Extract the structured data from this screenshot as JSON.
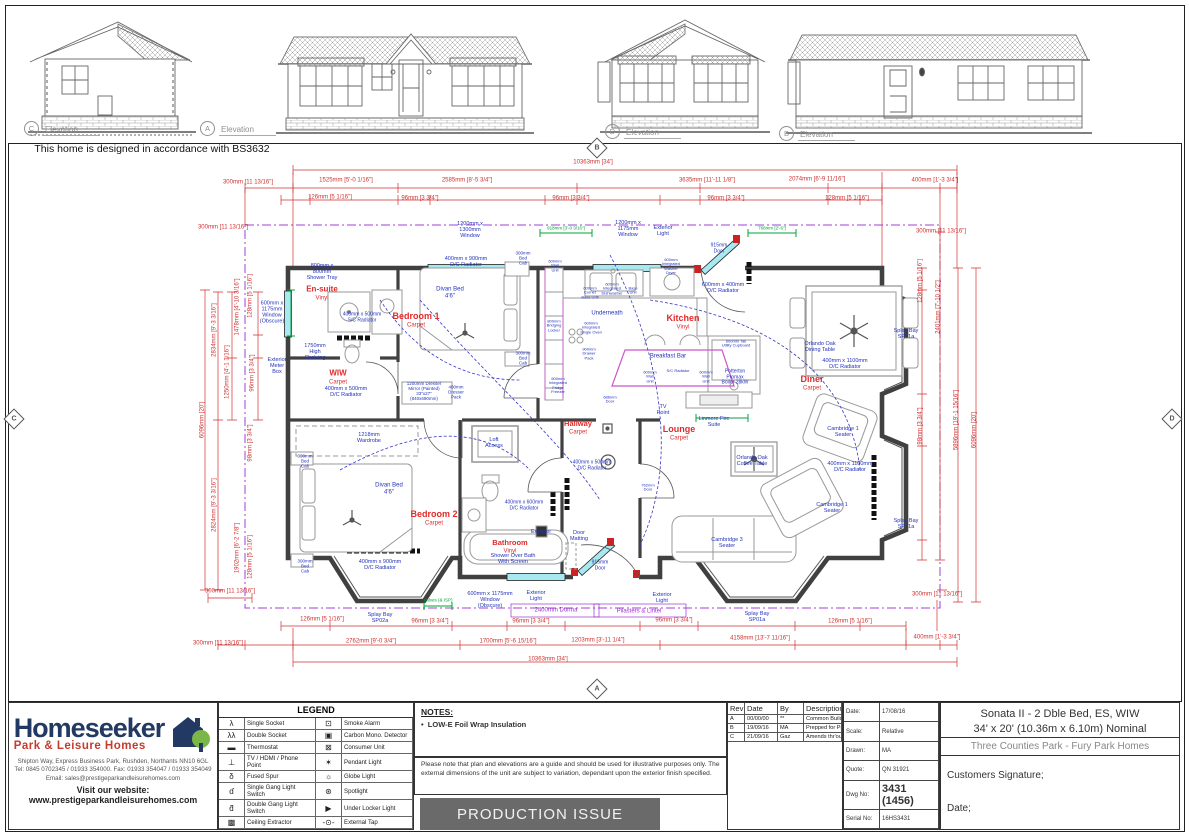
{
  "bs_note": "This home is designed in accordance with BS3632",
  "elevation_markers": [
    {
      "id": "C",
      "label": "Elevation",
      "x": 24,
      "y": 121
    },
    {
      "id": "A",
      "label": "Elevation",
      "x": 200,
      "y": 121
    },
    {
      "id": "D",
      "label": "Elevation",
      "x": 605,
      "y": 124
    },
    {
      "id": "B",
      "label": "Elevation",
      "x": 779,
      "y": 126
    }
  ],
  "view_markers": [
    {
      "id": "B",
      "x": 597,
      "y": 148
    },
    {
      "id": "C",
      "x": 14,
      "y": 419
    },
    {
      "id": "D",
      "x": 1172,
      "y": 419
    },
    {
      "id": "A",
      "x": 597,
      "y": 689
    }
  ],
  "plan_texts": [
    {
      "x": 322,
      "y": 290,
      "t": "En-suite",
      "c": "red",
      "fs": 8,
      "b": 1
    },
    {
      "x": 322,
      "y": 299,
      "t": "Vinyl",
      "c": "red",
      "fs": 6
    },
    {
      "x": 416,
      "y": 316,
      "t": "Bedroom 1",
      "c": "red",
      "fs": 9,
      "b": 1
    },
    {
      "x": 416,
      "y": 326,
      "t": "Carpet",
      "c": "red",
      "fs": 6
    },
    {
      "x": 338,
      "y": 374,
      "t": "WIW",
      "c": "red",
      "fs": 8,
      "b": 1
    },
    {
      "x": 338,
      "y": 383,
      "t": "Carpet",
      "c": "red",
      "fs": 6
    },
    {
      "x": 683,
      "y": 318,
      "t": "Kitchen",
      "c": "red",
      "fs": 9,
      "b": 1
    },
    {
      "x": 683,
      "y": 328,
      "t": "Vinyl",
      "c": "red",
      "fs": 6
    },
    {
      "x": 812,
      "y": 379,
      "t": "Diner",
      "c": "red",
      "fs": 9,
      "b": 1
    },
    {
      "x": 812,
      "y": 389,
      "t": "Carpet",
      "c": "red",
      "fs": 6
    },
    {
      "x": 679,
      "y": 429,
      "t": "Lounge",
      "c": "red",
      "fs": 9,
      "b": 1
    },
    {
      "x": 679,
      "y": 439,
      "t": "Carpet",
      "c": "red",
      "fs": 6
    },
    {
      "x": 578,
      "y": 424,
      "t": "Hallway",
      "c": "red",
      "fs": 7.5,
      "b": 1
    },
    {
      "x": 578,
      "y": 433,
      "t": "Carpet",
      "c": "red",
      "fs": 6
    },
    {
      "x": 434,
      "y": 514,
      "t": "Bedroom 2",
      "c": "red",
      "fs": 9,
      "b": 1
    },
    {
      "x": 434,
      "y": 524,
      "t": "Carpet",
      "c": "red",
      "fs": 6
    },
    {
      "x": 510,
      "y": 543,
      "t": "Bathroom",
      "c": "red",
      "fs": 7.5,
      "b": 1
    },
    {
      "x": 510,
      "y": 552,
      "t": "Vinyl",
      "c": "red",
      "fs": 6
    },
    {
      "x": 322,
      "y": 272,
      "t": "800mm x\n800mm\nShower Tray",
      "c": "blue",
      "fs": 5.5
    },
    {
      "x": 272,
      "y": 313,
      "t": "600mm x\n1175mm\nWindow\n(Obscure)",
      "c": "blue",
      "fs": 5.5
    },
    {
      "x": 362,
      "y": 318,
      "t": "400mm x 500mm\nS/C Radiator",
      "c": "blue",
      "fs": 5
    },
    {
      "x": 315,
      "y": 352,
      "t": "1750mm\nHigh\nShelving",
      "c": "blue",
      "fs": 5.5
    },
    {
      "x": 277,
      "y": 366,
      "t": "Exterior\nMeter\nBox",
      "c": "blue",
      "fs": 5.5
    },
    {
      "x": 346,
      "y": 392,
      "t": "400mm x 500mm\nD/C Radiator",
      "c": "blue",
      "fs": 5.5
    },
    {
      "x": 424,
      "y": 391,
      "t": "1200mm Dresser\nMirror (Painted)\n33\"x27\"\n(840x690mm)",
      "c": "blue",
      "fs": 4.5
    },
    {
      "x": 456,
      "y": 392,
      "t": "400mm\nDresser\nPack",
      "c": "blue",
      "fs": 4.5
    },
    {
      "x": 470,
      "y": 230,
      "t": "1200mm x\n1300mm\nWindow",
      "c": "blue",
      "fs": 5.5
    },
    {
      "x": 466,
      "y": 262,
      "t": "400mm x 900mm\nD/C Radiator",
      "c": "blue",
      "fs": 5.5
    },
    {
      "x": 450,
      "y": 293,
      "t": "Divan Bed\n4'6\"",
      "c": "blue",
      "fs": 6
    },
    {
      "x": 523,
      "y": 258,
      "t": "300mm\nBed\nCab",
      "c": "blue",
      "fs": 4.5
    },
    {
      "x": 523,
      "y": 358,
      "t": "300mm\nBed\nCab",
      "c": "blue",
      "fs": 4.5
    },
    {
      "x": 369,
      "y": 438,
      "t": "1218mm\nWardrobe",
      "c": "blue",
      "fs": 5.5
    },
    {
      "x": 389,
      "y": 489,
      "t": "Divan Bed\n4'6\"",
      "c": "blue",
      "fs": 6
    },
    {
      "x": 305,
      "y": 461,
      "t": "300mm\nBed\nCab",
      "c": "blue",
      "fs": 4.5
    },
    {
      "x": 305,
      "y": 566,
      "t": "300mm\nBed\nCab",
      "c": "blue",
      "fs": 4.5
    },
    {
      "x": 380,
      "y": 565,
      "t": "400mm x 900mm\nD/C Radiator",
      "c": "blue",
      "fs": 5.5
    },
    {
      "x": 494,
      "y": 443,
      "t": "Loft\nAccess",
      "c": "blue",
      "fs": 5.5
    },
    {
      "x": 524,
      "y": 506,
      "t": "400mm x 600mm\nD/C Radiator",
      "c": "blue",
      "fs": 5
    },
    {
      "x": 541,
      "y": 533,
      "t": "Extractor",
      "c": "blue",
      "fs": 5
    },
    {
      "x": 513,
      "y": 559,
      "t": "Shower Over Bath\nWith Screen",
      "c": "blue",
      "fs": 5.5
    },
    {
      "x": 490,
      "y": 600,
      "t": "600mm x 1175mm\nWindow\n(Obscure)",
      "c": "blue",
      "fs": 5.5
    },
    {
      "x": 536,
      "y": 596,
      "t": "Exterior\nLight",
      "c": "blue",
      "fs": 5.5
    },
    {
      "x": 662,
      "y": 598,
      "t": "Exterior\nLight",
      "c": "blue",
      "fs": 5.5
    },
    {
      "x": 600,
      "y": 566,
      "t": "915mm\nDoor",
      "c": "blue",
      "fs": 5
    },
    {
      "x": 579,
      "y": 536,
      "t": "Door\nMatting",
      "c": "blue",
      "fs": 5.5
    },
    {
      "x": 592,
      "y": 466,
      "t": "400mm x 500mm\nD/C Radiator",
      "c": "blue",
      "fs": 5
    },
    {
      "x": 663,
      "y": 410,
      "t": "TV\nPoint",
      "c": "blue",
      "fs": 5.5
    },
    {
      "x": 714,
      "y": 422,
      "t": "Linmere Fire\nSuite",
      "c": "blue",
      "fs": 5.5
    },
    {
      "x": 752,
      "y": 461,
      "t": "Orlando Oak\nCoffee Table",
      "c": "blue",
      "fs": 5.5
    },
    {
      "x": 843,
      "y": 432,
      "t": "Cambridge 1\nSeater",
      "c": "blue",
      "fs": 5.5
    },
    {
      "x": 832,
      "y": 508,
      "t": "Cambridge 1\nSeater",
      "c": "blue",
      "fs": 5.5
    },
    {
      "x": 727,
      "y": 543,
      "t": "Cambridge 3\nSeater",
      "c": "blue",
      "fs": 5.5
    },
    {
      "x": 850,
      "y": 467,
      "t": "400mm x 1100mm\nD/C Radiator",
      "c": "blue",
      "fs": 5.5
    },
    {
      "x": 845,
      "y": 364,
      "t": "400mm x 1100mm\nD/C Radiator",
      "c": "blue",
      "fs": 5.5
    },
    {
      "x": 820,
      "y": 347,
      "t": "Orlando Oak\nDining Table",
      "c": "blue",
      "fs": 5.5
    },
    {
      "x": 906,
      "y": 334,
      "t": "Splay Bay\nSP01a",
      "c": "blue",
      "fs": 5.5
    },
    {
      "x": 906,
      "y": 524,
      "t": "Splay Bay\nSP01a",
      "c": "blue",
      "fs": 5.5
    },
    {
      "x": 757,
      "y": 617,
      "t": "Splay Bay\nSP01a",
      "c": "blue",
      "fs": 5.5
    },
    {
      "x": 380,
      "y": 618,
      "t": "Splay Bay\nSP02a",
      "c": "blue",
      "fs": 5.5
    },
    {
      "x": 555,
      "y": 266,
      "t": "600mm\nWall\nUnit",
      "c": "blue",
      "fs": 4
    },
    {
      "x": 554,
      "y": 326,
      "t": "800mm\nBridging\nLocker",
      "c": "blue",
      "fs": 4
    },
    {
      "x": 558,
      "y": 386,
      "t": "600mm\nIntegrated\nFridge\nFreezer",
      "c": "blue",
      "fs": 4
    },
    {
      "x": 590,
      "y": 293,
      "t": "600mm\nCorner\nBase Unit",
      "c": "blue",
      "fs": 4
    },
    {
      "x": 612,
      "y": 289,
      "t": "600mm\nIntegrated\nDishwasher",
      "c": "blue",
      "fs": 4
    },
    {
      "x": 633,
      "y": 291,
      "t": "Base\nUnit",
      "c": "blue",
      "fs": 4
    },
    {
      "x": 671,
      "y": 267,
      "t": "600mm\nIntegrated\nWasher\nDryer",
      "c": "blue",
      "fs": 4
    },
    {
      "x": 607,
      "y": 314,
      "t": "Underneath",
      "c": "blue",
      "fs": 6
    },
    {
      "x": 591,
      "y": 328,
      "t": "600mm\nIntegrated\nSingle Oven",
      "c": "blue",
      "fs": 4
    },
    {
      "x": 589,
      "y": 354,
      "t": "900mm\nDrawer\nPack",
      "c": "blue",
      "fs": 4
    },
    {
      "x": 668,
      "y": 357,
      "t": "Breakfast Bar",
      "c": "blue",
      "fs": 6
    },
    {
      "x": 650,
      "y": 377,
      "t": "600mm\nWall\nUnit",
      "c": "blue",
      "fs": 4
    },
    {
      "x": 706,
      "y": 377,
      "t": "600mm\nWall\nUnit",
      "c": "blue",
      "fs": 4
    },
    {
      "x": 678,
      "y": 371,
      "t": "S/C Radiator",
      "c": "blue",
      "fs": 4
    },
    {
      "x": 735,
      "y": 378,
      "t": "Potterton\nPromax\nBoiler 28kW",
      "c": "blue",
      "fs": 5
    },
    {
      "x": 736,
      "y": 344,
      "t": "600mm Tall\nUtility Cupboard",
      "c": "blue",
      "fs": 4
    },
    {
      "x": 723,
      "y": 288,
      "t": "600mm x 400mm\nD/C Radiator",
      "c": "blue",
      "fs": 5.5
    },
    {
      "x": 719,
      "y": 249,
      "t": "915mm\nDoor",
      "c": "blue",
      "fs": 5
    },
    {
      "x": 663,
      "y": 231,
      "t": "Exterior\nLight",
      "c": "blue",
      "fs": 5.5
    },
    {
      "x": 628,
      "y": 229,
      "t": "1200mm x\n1175mm\nWindow",
      "c": "blue",
      "fs": 5.5
    },
    {
      "x": 648,
      "y": 488,
      "t": "762mm\nDoor",
      "c": "blue",
      "fs": 4
    },
    {
      "x": 610,
      "y": 400,
      "t": "686mm\nDoor",
      "c": "blue",
      "fs": 4
    },
    {
      "x": 566,
      "y": 228,
      "t": "918mm [3'-0 3/16\"]",
      "c": "green",
      "fs": 4.5
    },
    {
      "x": 772,
      "y": 228,
      "t": "768mm [2'-6\"]",
      "c": "green",
      "fs": 4.5
    },
    {
      "x": 438,
      "y": 600,
      "t": "Valves (& ISP)",
      "c": "green",
      "fs": 4.5
    },
    {
      "x": 556,
      "y": 611,
      "t": "2400mm Dorma",
      "c": "purple",
      "fs": 6
    },
    {
      "x": 639,
      "y": 612,
      "t": "Pilasters & Lintel",
      "c": "purple",
      "fs": 6
    },
    {
      "x": 593,
      "y": 163,
      "t": "10363mm [34']",
      "c": "dim",
      "fs": 6
    },
    {
      "x": 248,
      "y": 183,
      "t": "300mm [11 13/16\"]",
      "c": "dim",
      "fs": 6
    },
    {
      "x": 346,
      "y": 181,
      "t": "1525mm [5'-0 1/16\"]",
      "c": "dim",
      "fs": 6
    },
    {
      "x": 467,
      "y": 181,
      "t": "2585mm [8'-5 3/4\"]",
      "c": "dim",
      "fs": 6
    },
    {
      "x": 707,
      "y": 181,
      "t": "3635mm [11'-11 1/8\"]",
      "c": "dim",
      "fs": 6
    },
    {
      "x": 817,
      "y": 180,
      "t": "2074mm [6'-9 11/16\"]",
      "c": "dim",
      "fs": 6
    },
    {
      "x": 935,
      "y": 181,
      "t": "400mm [1'-3 3/4\"]",
      "c": "dim",
      "fs": 6
    },
    {
      "x": 330,
      "y": 198,
      "t": "126mm [5 1/16\"]",
      "c": "dim",
      "fs": 6
    },
    {
      "x": 420,
      "y": 199,
      "t": "96mm [3 3/4\"]",
      "c": "dim",
      "fs": 6
    },
    {
      "x": 571,
      "y": 199,
      "t": "96mm [3 3/4\"]",
      "c": "dim",
      "fs": 6
    },
    {
      "x": 726,
      "y": 199,
      "t": "96mm [3 3/4\"]",
      "c": "dim",
      "fs": 6
    },
    {
      "x": 847,
      "y": 199,
      "t": "128mm [5 1/16\"]",
      "c": "dim",
      "fs": 6
    },
    {
      "x": 223,
      "y": 228,
      "t": "300mm [11 13/16\"]",
      "c": "dim",
      "fs": 6
    },
    {
      "x": 941,
      "y": 232,
      "t": "300mm [11 13/16\"]",
      "c": "dim",
      "fs": 6
    },
    {
      "x": 203,
      "y": 420,
      "t": "6096mm [20']",
      "c": "dim",
      "fs": 6,
      "r": 1
    },
    {
      "x": 215,
      "y": 330,
      "t": "2834mm [9'-3 3/16\"]",
      "c": "dim",
      "fs": 6,
      "r": 1
    },
    {
      "x": 215,
      "y": 505,
      "t": "2824mm [9'-3 3/16\"]",
      "c": "dim",
      "fs": 6,
      "r": 1
    },
    {
      "x": 238,
      "y": 307,
      "t": "1478mm [4'-10 3/16\"]",
      "c": "dim",
      "fs": 6,
      "r": 1
    },
    {
      "x": 251,
      "y": 296,
      "t": "128mm [5 1/16\"]",
      "c": "dim",
      "fs": 6,
      "r": 1
    },
    {
      "x": 228,
      "y": 372,
      "t": "1250mm [4'-1 3/16\"]",
      "c": "dim",
      "fs": 6,
      "r": 1
    },
    {
      "x": 253,
      "y": 373,
      "t": "96mm [3 3/4\"]",
      "c": "dim",
      "fs": 6,
      "r": 1
    },
    {
      "x": 251,
      "y": 443,
      "t": "98mm [3 3/4\"]",
      "c": "dim",
      "fs": 6,
      "r": 1
    },
    {
      "x": 238,
      "y": 548,
      "t": "1902mm [6'-2 7/8\"]",
      "c": "dim",
      "fs": 6,
      "r": 1
    },
    {
      "x": 251,
      "y": 557,
      "t": "128mm [5 1/16\"]",
      "c": "dim",
      "fs": 6,
      "r": 1
    },
    {
      "x": 921,
      "y": 281,
      "t": "128mm [5 1/16\"]",
      "c": "dim",
      "fs": 6,
      "r": 1
    },
    {
      "x": 939,
      "y": 307,
      "t": "2401mm [7'-10 1/2\"]",
      "c": "dim",
      "fs": 6,
      "r": 1
    },
    {
      "x": 921,
      "y": 426,
      "t": "98mm [3 3/4\"]",
      "c": "dim",
      "fs": 6,
      "r": 1
    },
    {
      "x": 957,
      "y": 420,
      "t": "5896mm [19'-1 15/16\"]",
      "c": "dim",
      "fs": 6,
      "r": 1
    },
    {
      "x": 975,
      "y": 430,
      "t": "6096mm [20']",
      "c": "dim",
      "fs": 6,
      "r": 1
    },
    {
      "x": 230,
      "y": 592,
      "t": "300mm [11 13/16\"]",
      "c": "dim",
      "fs": 6
    },
    {
      "x": 322,
      "y": 620,
      "t": "126mm [5 1/16\"]",
      "c": "dim",
      "fs": 6
    },
    {
      "x": 430,
      "y": 622,
      "t": "96mm [3 3/4\"]",
      "c": "dim",
      "fs": 6
    },
    {
      "x": 531,
      "y": 622,
      "t": "96mm [3 3/4\"]",
      "c": "dim",
      "fs": 6
    },
    {
      "x": 674,
      "y": 621,
      "t": "96mm [3 3/4\"]",
      "c": "dim",
      "fs": 6
    },
    {
      "x": 850,
      "y": 622,
      "t": "126mm [5 1/16\"]",
      "c": "dim",
      "fs": 6
    },
    {
      "x": 218,
      "y": 644,
      "t": "300mm [11 13/16\"]",
      "c": "dim",
      "fs": 6
    },
    {
      "x": 371,
      "y": 642,
      "t": "2762mm [9'-0 3/4\"]",
      "c": "dim",
      "fs": 6
    },
    {
      "x": 508,
      "y": 642,
      "t": "1700mm [5'-6 15/16\"]",
      "c": "dim",
      "fs": 6
    },
    {
      "x": 598,
      "y": 641,
      "t": "1203mm [3'-11 1/4\"]",
      "c": "dim",
      "fs": 6
    },
    {
      "x": 760,
      "y": 639,
      "t": "4158mm [13'-7 11/16\"]",
      "c": "dim",
      "fs": 6
    },
    {
      "x": 937,
      "y": 638,
      "t": "400mm [1'-3 3/4\"]",
      "c": "dim",
      "fs": 6
    },
    {
      "x": 937,
      "y": 595,
      "t": "300mm [11 13/16\"]",
      "c": "dim",
      "fs": 6
    },
    {
      "x": 548,
      "y": 660,
      "t": "10363mm [34']",
      "c": "dim",
      "fs": 6
    }
  ],
  "footer": {
    "logo": {
      "name": "Homeseeker",
      "tagline": "Park & Leisure Homes",
      "address1": "Shipton Way, Express Business Park, Rushden, Northants NN10 6GL",
      "address2": "Tel: 0845 0702345 / 01933 354000.   Fax: 01933 354047 / 01933 354049",
      "address3": "Email: sales@prestigeparkandleisurehomes.com",
      "website": "Visit our website: www.prestigeparkandleisurehomes.com"
    },
    "legend": {
      "title": "LEGEND",
      "left": [
        {
          "icon": "λ",
          "name": "single-socket",
          "label": "Single Socket"
        },
        {
          "icon": "λλ",
          "name": "double-socket",
          "label": "Double Socket"
        },
        {
          "icon": "▬",
          "name": "thermostat",
          "label": "Thermostat"
        },
        {
          "icon": "⊥",
          "name": "tv-hdmi-phone-point",
          "label": "TV / HDMI / Phone Point"
        },
        {
          "icon": "δ",
          "name": "fused-spur",
          "label": "Fused Spur"
        },
        {
          "icon": "ɗ",
          "name": "single-gang-light-switch",
          "label": "Single Gang Light Switch"
        },
        {
          "icon": "ƌ",
          "name": "double-gang-light-switch",
          "label": "Double Gang Light Switch"
        },
        {
          "icon": "▩",
          "name": "ceiling-extractor",
          "label": "Ceiling Extractor"
        }
      ],
      "right": [
        {
          "icon": "⊡",
          "name": "smoke-alarm",
          "label": "Smoke Alarm"
        },
        {
          "icon": "▣",
          "name": "carbon-mono-detector",
          "label": "Carbon Mono. Detector"
        },
        {
          "icon": "⊠",
          "name": "consumer-unit",
          "label": "Consumer Unit"
        },
        {
          "icon": "✶",
          "name": "pendant-light",
          "label": "Pendant Light"
        },
        {
          "icon": "☼",
          "name": "globe-light",
          "label": "Globe Light"
        },
        {
          "icon": "⊛",
          "name": "spotlight",
          "label": "Spotlight"
        },
        {
          "icon": "▶",
          "name": "under-locker-light",
          "label": "Under Locker Light"
        },
        {
          "icon": "-⊙-",
          "name": "external-tap",
          "label": "External Tap"
        }
      ]
    },
    "notes": {
      "title": "NOTES:",
      "bullet": "LOW-E Foil Wrap Insulation",
      "para": "Please note that plan and elevations are a guide and should be used for illustrative purposes only. The external dimensions of the unit are subject to variation, dependant upon the exterior finish specified.",
      "production": "PRODUCTION ISSUE"
    },
    "revisions": {
      "headers": [
        "Rev",
        "Date",
        "By",
        "Description"
      ],
      "rows": [
        [
          "A",
          "00/00/00",
          "**",
          "Common Build Applied"
        ],
        [
          "B",
          "19/09/16",
          "MA",
          "Prepped for Production"
        ],
        [
          "C",
          "21/09/16",
          "Gaz",
          "Amends thr'out & Productionised"
        ]
      ]
    },
    "info": {
      "rows": [
        {
          "label": "Date:",
          "value": "17/08/16",
          "big": 0
        },
        {
          "label": "Scale:",
          "value": "Relative",
          "big": 0
        },
        {
          "label": "Drawn:",
          "value": "MA",
          "big": 0
        },
        {
          "label": "Quote:",
          "value": "QN 31921",
          "big": 0
        },
        {
          "label": "Dwg No:",
          "value": "3431 (1456)",
          "big": 1
        },
        {
          "label": "Serial No:",
          "value": "16HS3431",
          "big": 0
        }
      ]
    },
    "title": {
      "line1": "Sonata II - 2 Dble Bed, ES, WIW",
      "line2": "34' x 20' (10.36m x 6.10m) Nominal",
      "park": "Three Counties Park - Fury Park Homes",
      "signature": "Customers Signature;",
      "date": "Date;"
    }
  }
}
